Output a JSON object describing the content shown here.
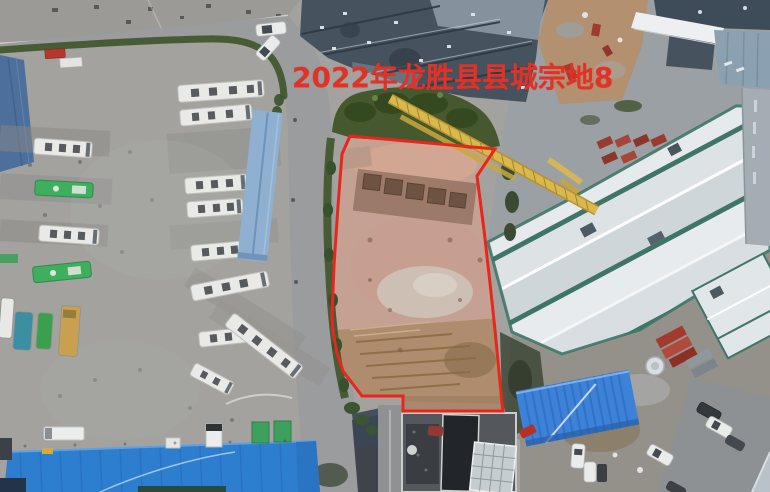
{
  "annotation": {
    "text": "2022年龙胜县县城宗地8",
    "color": "#e23227"
  },
  "parcel": {
    "points": "350,136 495,149 477,176 484,230 490,283 495,330 502,403 503,411 403,411 403,396 362,396 343,371 337,353 333,332 332,316 334,266 338,206 342,154",
    "stroke": "#e8261c",
    "stroke_width": "3"
  },
  "colors": {
    "asphalt": "#a3a29e",
    "road": "#9b9c9e",
    "parcel_dirt": "#c5a194",
    "vegetation": "#42572f",
    "roof_slate": "#46525e",
    "left_roof_blue": "#4c6f9b",
    "warehouse_blue": "#2e7ecf",
    "canopy_blue": "#8fb0d0",
    "shed_blue": "#3b82d8",
    "crane_yellow": "#d9b84e",
    "building_white": "#e3e7e9",
    "building_trim": "#3f7568",
    "bus_white": "#e9e9e7",
    "bus_green": "#3fae5e"
  }
}
